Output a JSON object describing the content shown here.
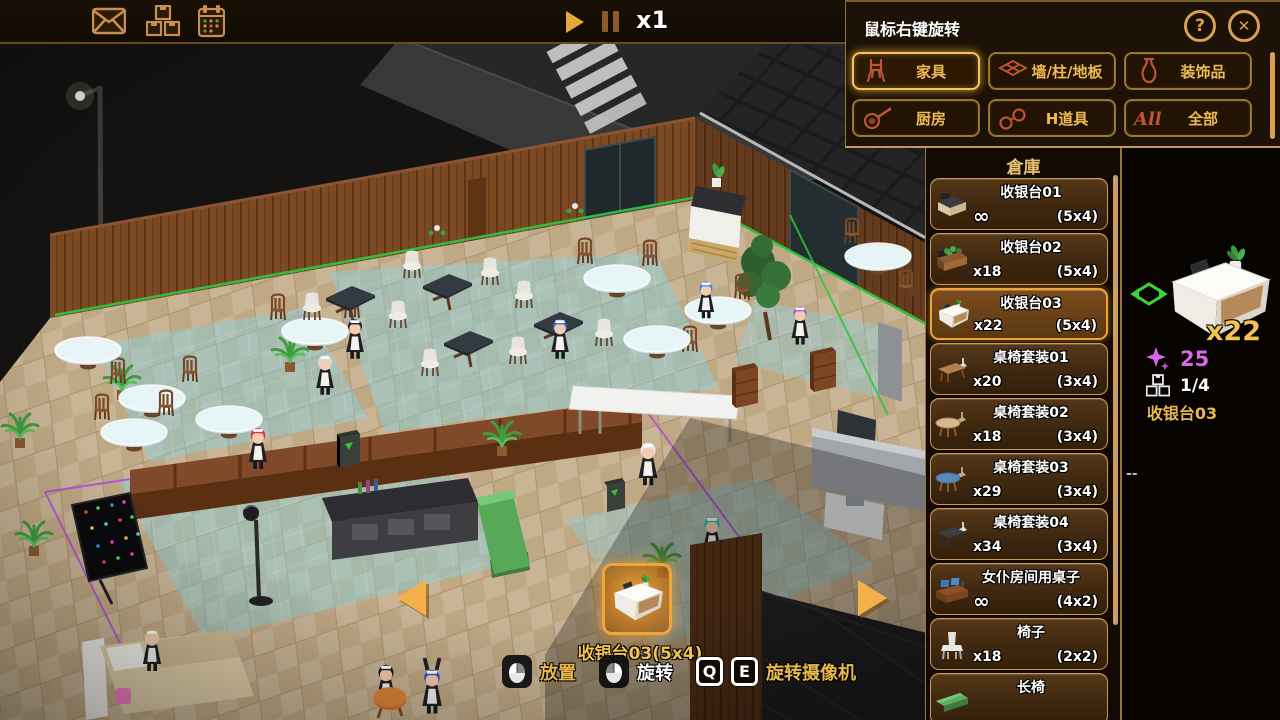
{
  "topbar": {
    "icons": [
      "mail-icon",
      "storage-icon",
      "calendar-icon"
    ],
    "play_icon": "play-icon",
    "pause_icon": "pause-icon",
    "speed": "x1"
  },
  "build_panel": {
    "hint": "鼠标右键旋转",
    "help": "?",
    "categories": [
      {
        "label": "家具",
        "icon": "chair",
        "selected": true
      },
      {
        "label": "墙/柱/地板",
        "icon": "tiles",
        "selected": false
      },
      {
        "label": "装饰品",
        "icon": "vase",
        "selected": false
      },
      {
        "label": "厨房",
        "icon": "pan",
        "selected": false
      },
      {
        "label": "H道具",
        "icon": "cuffs",
        "selected": false
      },
      {
        "label": "全部",
        "icon": "all",
        "selected": false
      }
    ]
  },
  "warehouse": {
    "title": "倉庫",
    "items": [
      {
        "name": "收银台01",
        "count": "∞",
        "size": "(5x4)",
        "icon": "regD",
        "selected": false
      },
      {
        "name": "收银台02",
        "count": "x18",
        "size": "(5x4)",
        "icon": "regP",
        "selected": false
      },
      {
        "name": "收银台03",
        "count": "x22",
        "size": "(5x4)",
        "icon": "regW",
        "selected": true
      },
      {
        "name": "桌椅套装01",
        "count": "x20",
        "size": "(3x4)",
        "icon": "setA",
        "selected": false
      },
      {
        "name": "桌椅套装02",
        "count": "x18",
        "size": "(3x4)",
        "icon": "setB",
        "selected": false
      },
      {
        "name": "桌椅套装03",
        "count": "x29",
        "size": "(3x4)",
        "icon": "setC",
        "selected": false
      },
      {
        "name": "桌椅套装04",
        "count": "x34",
        "size": "(3x4)",
        "icon": "setD",
        "selected": false
      },
      {
        "name": "女仆房间用桌子",
        "count": "∞",
        "size": "(4x2)",
        "icon": "mdesk",
        "selected": false
      },
      {
        "name": "椅子",
        "count": "x18",
        "size": "(2x2)",
        "icon": "chairW",
        "selected": false
      },
      {
        "name": "长椅",
        "count": "",
        "size": "",
        "icon": "benchG",
        "selected": false
      }
    ]
  },
  "detail": {
    "owned": "x22",
    "gem_cost": "25",
    "progress": "1/4",
    "item_name": "收银台03",
    "placeholder": "--"
  },
  "placement": {
    "label": "收银台03(5x4)"
  },
  "hotkeys": [
    {
      "icon": "mouse-left-icon",
      "label": "放置",
      "color": "gold"
    },
    {
      "icon": "mouse-right-icon",
      "label": "旋转",
      "color": "white"
    },
    {
      "icon": "qe-keys",
      "keys": [
        "Q",
        "E"
      ],
      "label": "旋转摄像机",
      "color": "gold"
    }
  ],
  "scene": {
    "colors": {
      "floor": "#c9b596",
      "wall": "#7b4a24",
      "tile_highlight": "#86d2e2",
      "grid_green": "#2ec43e",
      "grid_purple": "#b44fd6",
      "accent": "#f2a233",
      "gold": "#e8b84b"
    }
  }
}
